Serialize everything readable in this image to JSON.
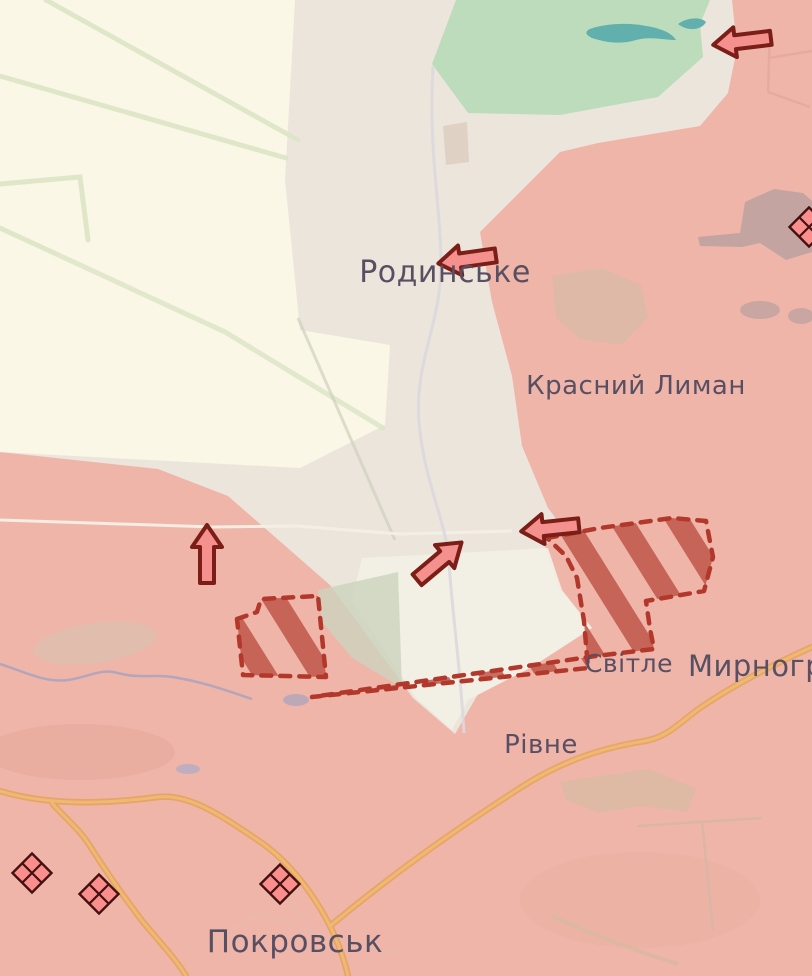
{
  "map": {
    "type": "military-situation-map",
    "settlement_labels": {
      "rodynske": "Родинське",
      "krasnyi_lyman": "Красний Лиман",
      "svitle": "Світле",
      "myrnohrad": "Мирноград",
      "rivne": "Рівне",
      "pokrovsk": "Покровськ"
    },
    "colors": {
      "contested_area": "#ECE5DC",
      "fields_area": "#FAF7E6",
      "occupied_area": "#EFB5A9",
      "forest": "#BCDCBB",
      "water": "#62B0AD",
      "advance_hatch": "#C0564A",
      "advance_border": "#B2382B",
      "arrow_fill": "#F4918E",
      "arrow_outline": "#7A1E17",
      "marker_fill": "#F98E8C",
      "marker_outline": "#431110",
      "road_orange": "#EFB873",
      "label_text": "#584F63"
    },
    "attack_arrows": [
      {
        "name": "attack-arrow-top-right",
        "direction": "left"
      },
      {
        "name": "attack-arrow-rodynske",
        "direction": "left"
      },
      {
        "name": "attack-arrow-west",
        "direction": "up"
      },
      {
        "name": "attack-arrow-center",
        "direction": "up-right"
      },
      {
        "name": "attack-arrow-svitle",
        "direction": "left"
      }
    ],
    "advance_areas": [
      {
        "name": "advance-area-west-of-svitle",
        "style": "red-hatched-dashed"
      },
      {
        "name": "advance-area-svitle",
        "style": "red-hatched-dashed"
      }
    ],
    "fortification_markers": {
      "shape": "crossed-diamond",
      "count": 4
    }
  }
}
